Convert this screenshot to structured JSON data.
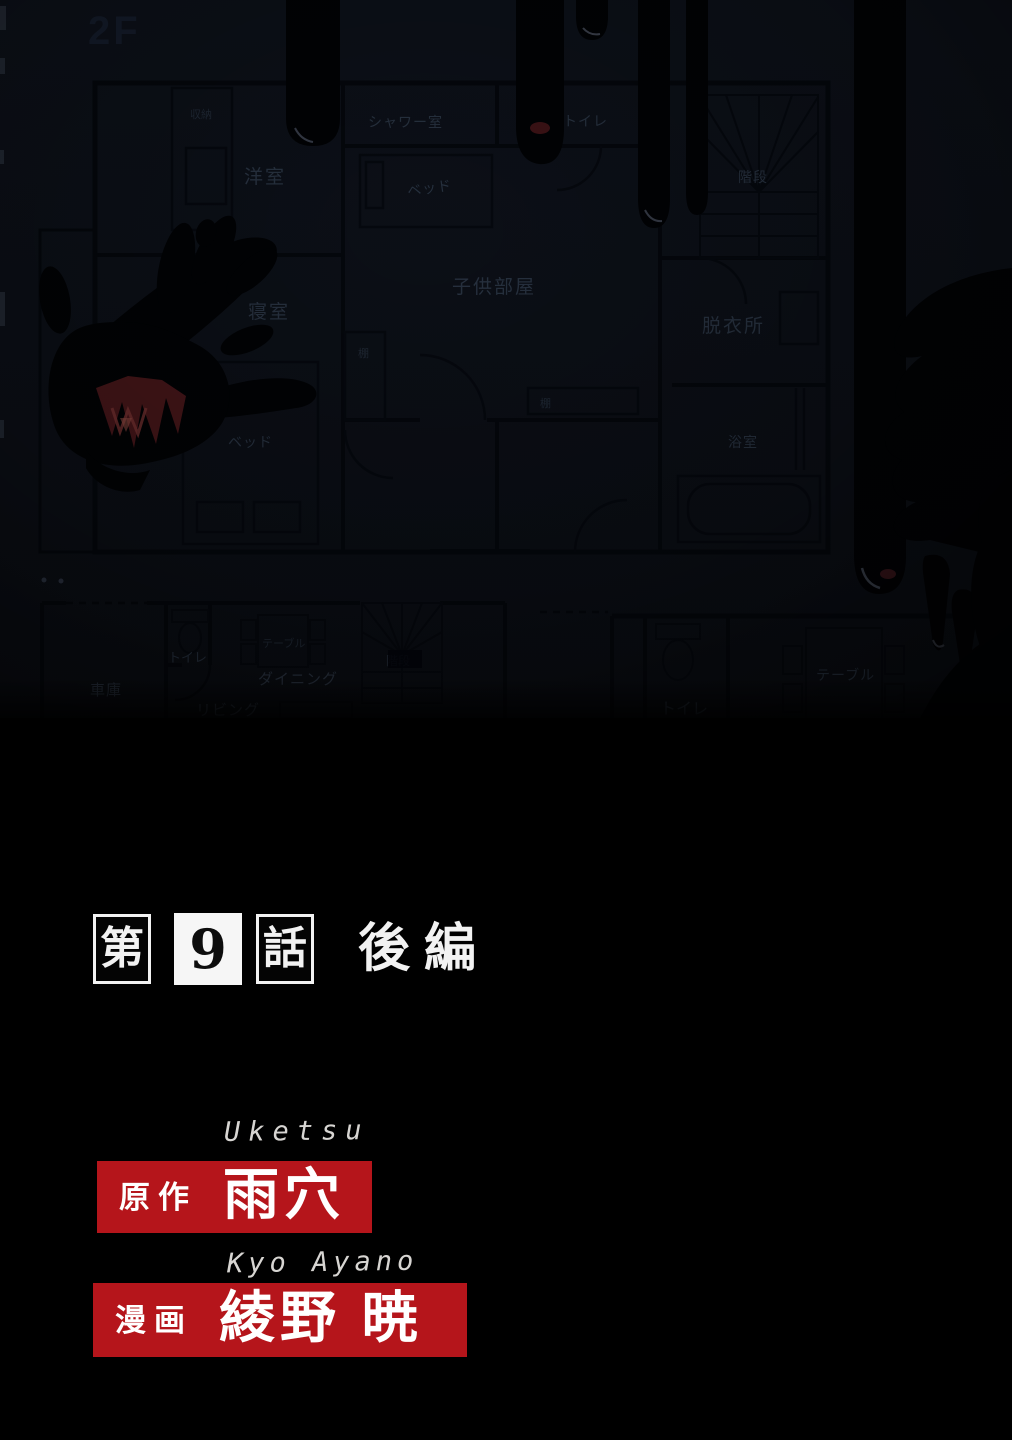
{
  "episode": {
    "prefix": "第",
    "number": "9",
    "suffix": "話",
    "part": "後編"
  },
  "credits": {
    "original": {
      "romaji": "Uketsu",
      "role": "原作",
      "name": "雨穴"
    },
    "artist": {
      "romaji": "Kyo Ayano",
      "role": "漫画",
      "name": "綾野 暁"
    }
  },
  "colors": {
    "accent_red": "#b5151b",
    "plan_background": "#0b0f16",
    "plan_line": "#04070c",
    "blood_black": "#010204",
    "title_white": "#f2f2f2"
  },
  "floorplan": {
    "floor_label": "2F",
    "labels": {
      "western_room": "洋室",
      "closet": "収納",
      "bedroom": "寝室",
      "balcony": "バルコニー",
      "bed": "ベッド",
      "shower_room": "シャワー室",
      "toilet": "トイレ",
      "kids_room": "子供部屋",
      "shelf": "棚",
      "stairs": "階段",
      "changing_room": "脱衣所",
      "bathroom": "浴室",
      "garage": "車庫",
      "table": "テーブル",
      "dining": "ダイニング",
      "living": "リビング"
    }
  }
}
